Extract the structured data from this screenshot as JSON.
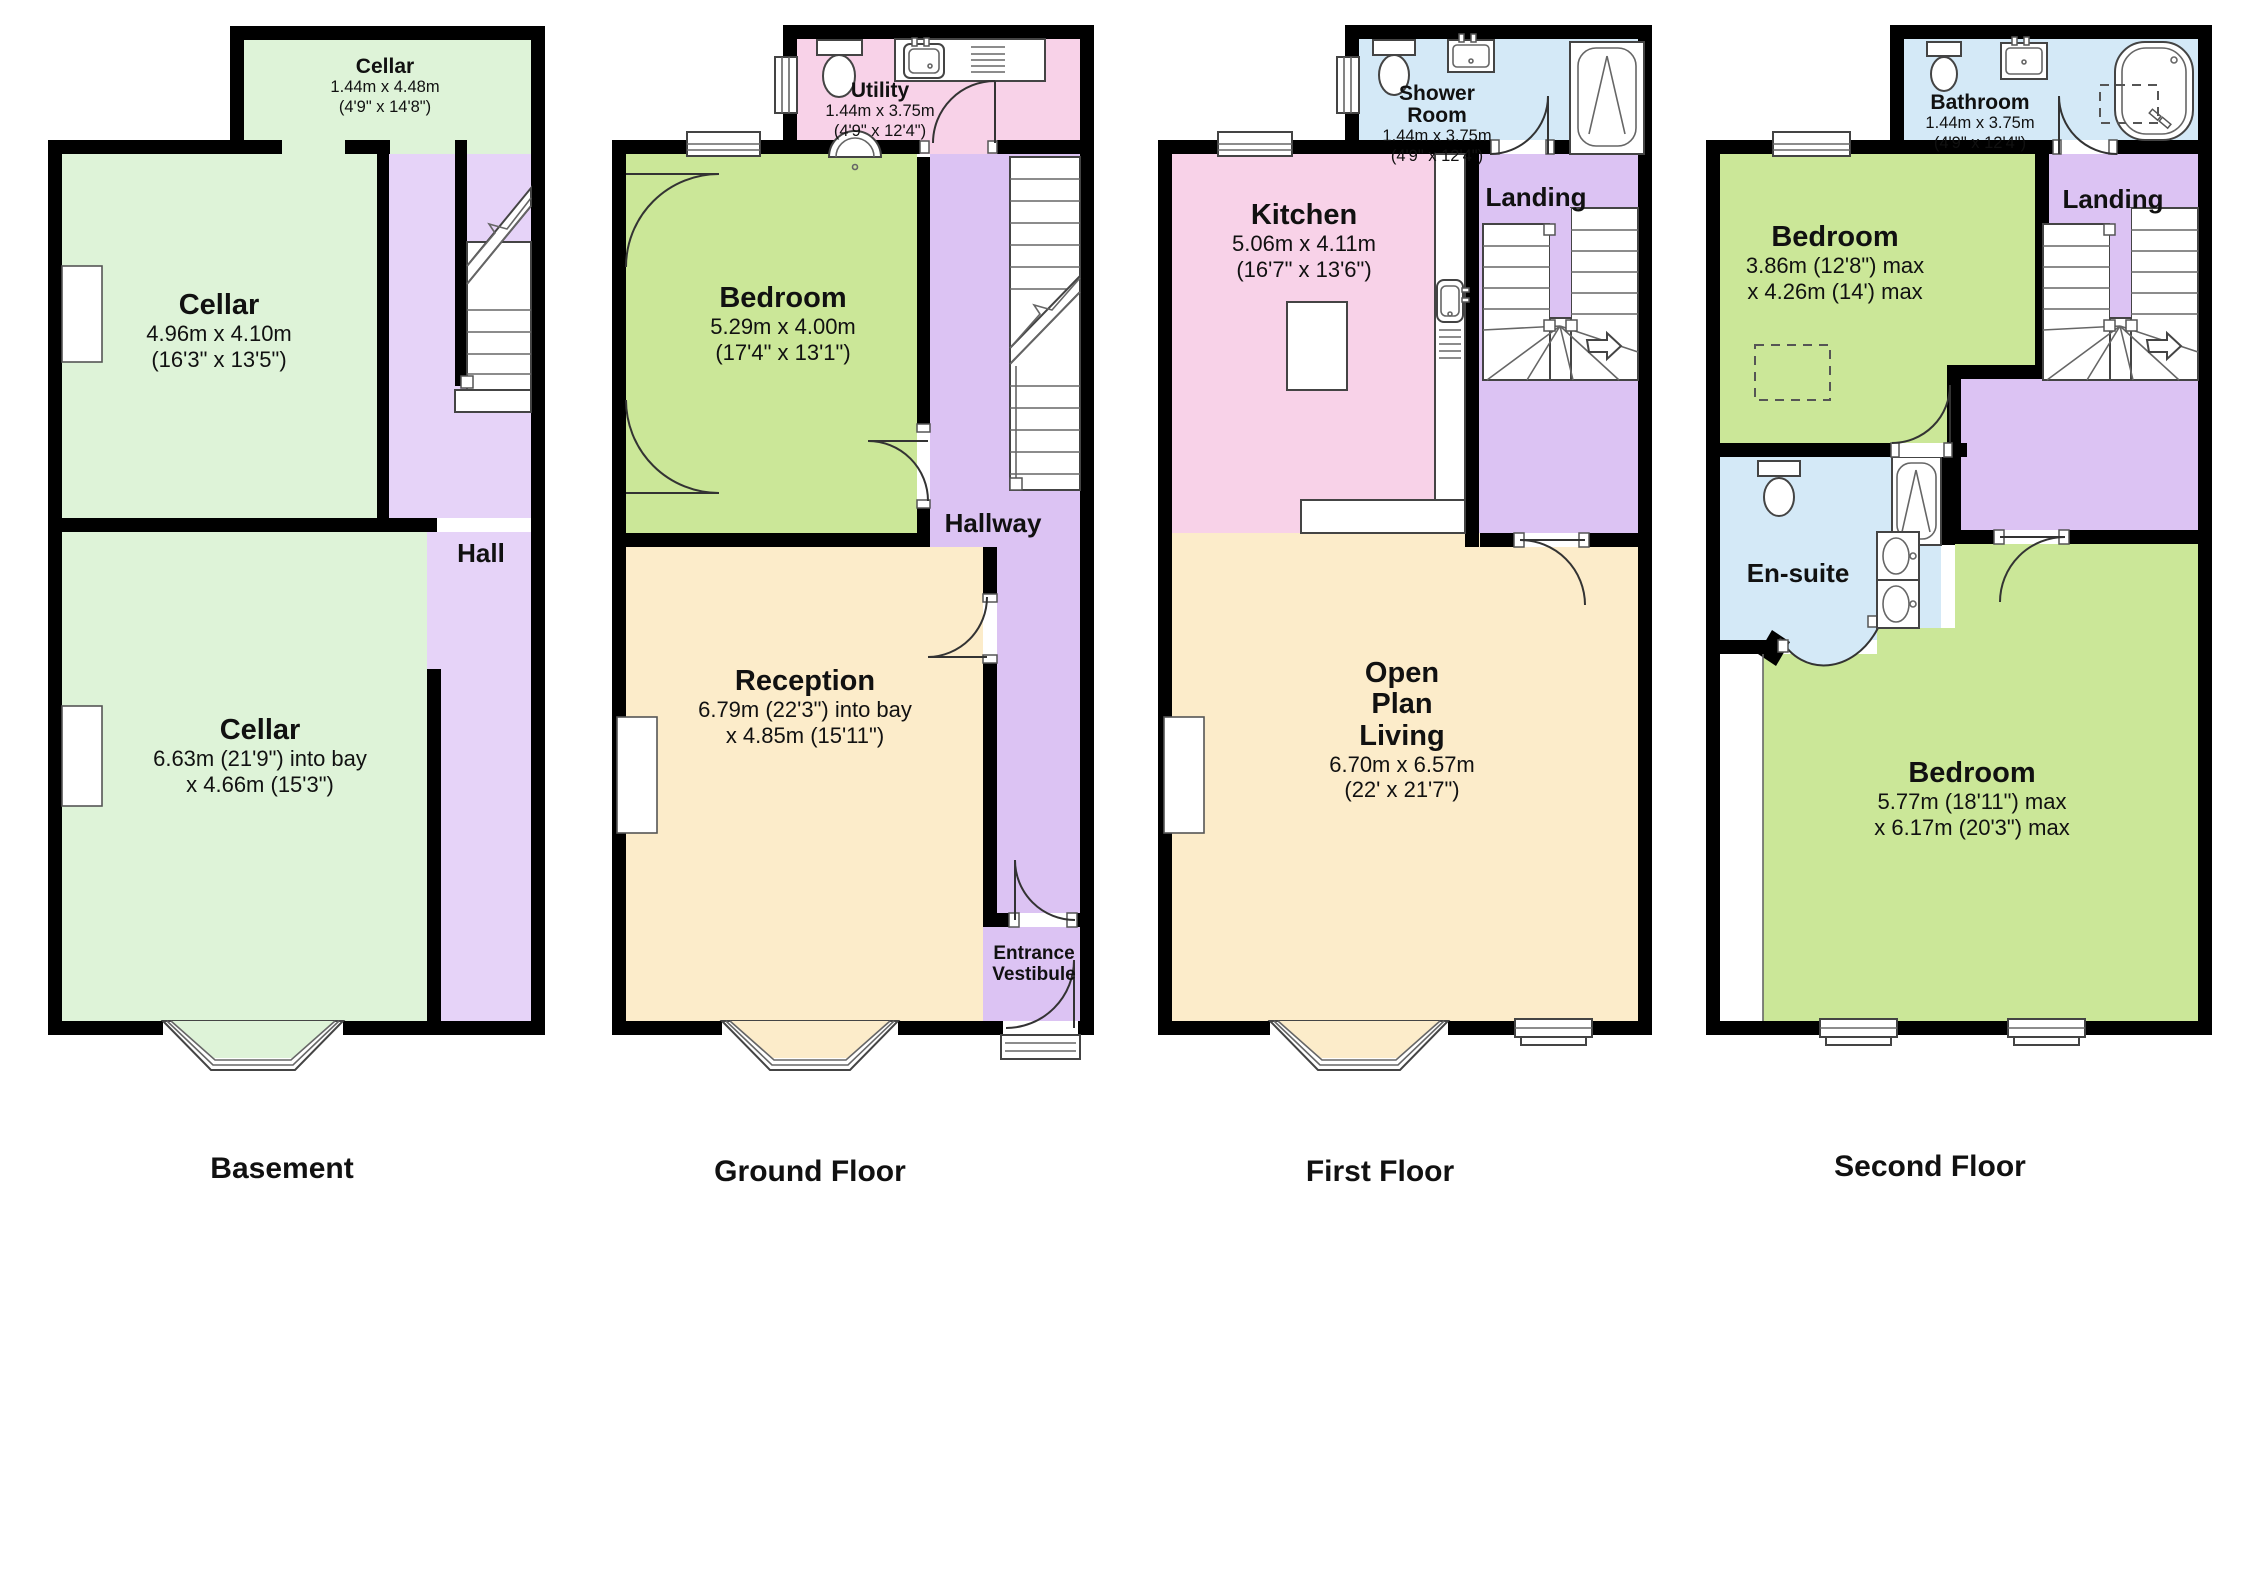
{
  "colors": {
    "wall": "#000000",
    "cellar": "#def3d8",
    "green": "#cbe798",
    "hall": "#e6d3f8",
    "purple": "#dcc3f3",
    "pink": "#f8d2e8",
    "peach": "#fcecca",
    "blue": "#d4e9f7",
    "white": "#ffffff"
  },
  "floors": [
    {
      "label": "Basement",
      "rooms": [
        {
          "name": "Cellar",
          "dims": [
            "1.44m x 4.48m",
            "(4'9\" x 14'8\")"
          ]
        },
        {
          "name": "Cellar",
          "dims": [
            "4.96m x 4.10m",
            "(16'3\" x 13'5\")"
          ]
        },
        {
          "name": "Hall",
          "dims": []
        },
        {
          "name": "Cellar",
          "dims": [
            "6.63m (21'9\") into bay",
            "x 4.66m (15'3\")"
          ]
        }
      ]
    },
    {
      "label": "Ground Floor",
      "rooms": [
        {
          "name": "Utility",
          "dims": [
            "1.44m x 3.75m",
            "(4'9\" x 12'4\")"
          ]
        },
        {
          "name": "Bedroom",
          "dims": [
            "5.29m x 4.00m",
            "(17'4\" x 13'1\")"
          ]
        },
        {
          "name": "Hallway",
          "dims": []
        },
        {
          "name": "Reception",
          "dims": [
            "6.79m (22'3\") into bay",
            "x 4.85m (15'11\")"
          ]
        },
        {
          "name": "Entrance Vestibule",
          "dims": []
        }
      ]
    },
    {
      "label": "First Floor",
      "rooms": [
        {
          "name": "Shower Room",
          "dims": [
            "1.44m x 3.75m",
            "(4'9\" x 12'4\")"
          ]
        },
        {
          "name": "Kitchen",
          "dims": [
            "5.06m x 4.11m",
            "(16'7\" x 13'6\")"
          ]
        },
        {
          "name": "Landing",
          "dims": []
        },
        {
          "name": "Open Plan Living",
          "dims": [
            "6.70m x 6.57m",
            "(22' x 21'7\")"
          ]
        }
      ]
    },
    {
      "label": "Second Floor",
      "rooms": [
        {
          "name": "Bathroom",
          "dims": [
            "1.44m x 3.75m",
            "(4'9\" x 12'4\")"
          ]
        },
        {
          "name": "Bedroom",
          "dims": [
            "3.86m (12'8\") max",
            "x 4.26m (14') max"
          ]
        },
        {
          "name": "Landing",
          "dims": []
        },
        {
          "name": "En-suite",
          "dims": []
        },
        {
          "name": "Bedroom",
          "dims": [
            "5.77m (18'11\") max",
            "x 6.17m (20'3\") max"
          ]
        }
      ]
    }
  ]
}
